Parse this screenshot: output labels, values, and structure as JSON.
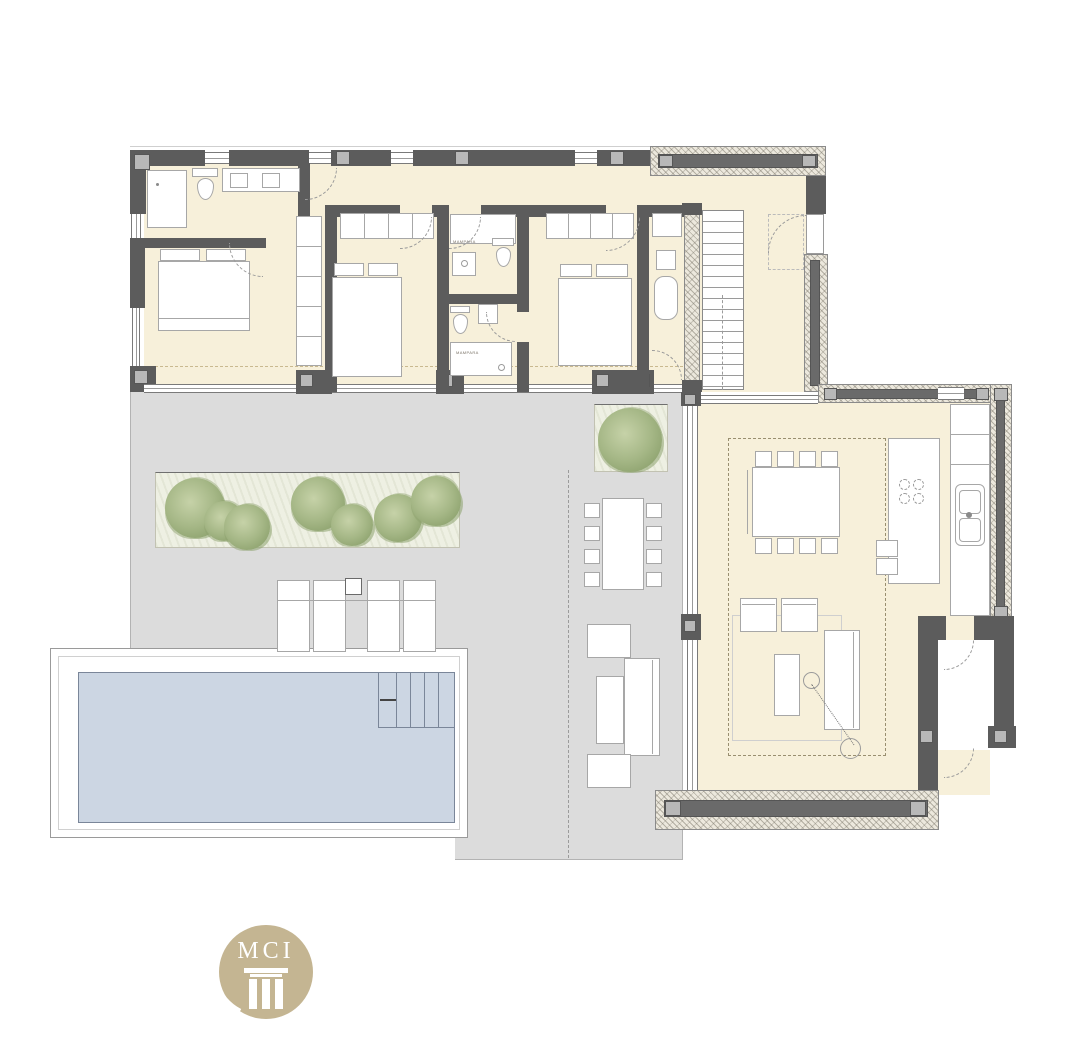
{
  "document_type": "residential floor plan",
  "logo": {
    "text": "MCI",
    "circle_color": "#c4b592",
    "text_color": "#ffffff"
  },
  "annotations": {
    "shower_screen_label_1": "MAMPARA",
    "shower_screen_label_2": "MAMPARA"
  },
  "palette": {
    "wall": "#5c5c5c",
    "wall_column_block": "#b8b8b8",
    "insulated_wall_hatch": "#ece8dd",
    "interior_floor": "#f7f0da",
    "terrace": "#dcdcdc",
    "pool_water": "#ccd6e3",
    "pool_deck": "#ffffff",
    "vegetation": "#a5b786",
    "planter_bed": "#eef0e3",
    "furniture_outline": "#a7a7a7",
    "roof_overhang_dash": "#c9b98f",
    "zone_dash": "#998f70"
  }
}
